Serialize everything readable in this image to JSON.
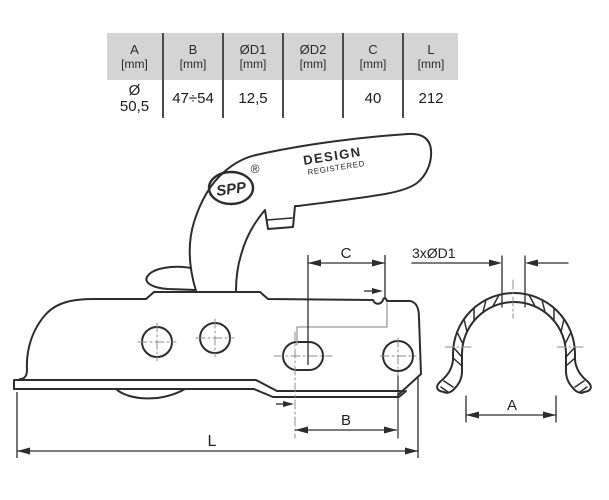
{
  "table": {
    "headers": [
      {
        "name": "A",
        "unit": "[mm]"
      },
      {
        "name": "B",
        "unit": "[mm]"
      },
      {
        "name": "ØD1",
        "unit": "[mm]"
      },
      {
        "name": "ØD2",
        "unit": "[mm]"
      },
      {
        "name": "C",
        "unit": "[mm]"
      },
      {
        "name": "L",
        "unit": "[mm]"
      }
    ],
    "values": [
      "Ø\n50,5",
      "47÷54",
      "12,5",
      "",
      "40",
      "212"
    ]
  },
  "drawing": {
    "brand": "SPP",
    "registered_symbol": "®",
    "design_registered_line1": "DESIGN",
    "design_registered_line2": "REGISTERED",
    "dimension_labels": {
      "c": "C",
      "d1": "3xØD1",
      "b": "B",
      "l": "L",
      "a": "A"
    }
  },
  "colors": {
    "background": "#ffffff",
    "line": "#2d2d2d",
    "table_header_bg": "#d4d4d4",
    "table_divider": "#4a4a4a",
    "centerline": "#8f8f8f",
    "hidden_line": "#9a9a9a"
  }
}
